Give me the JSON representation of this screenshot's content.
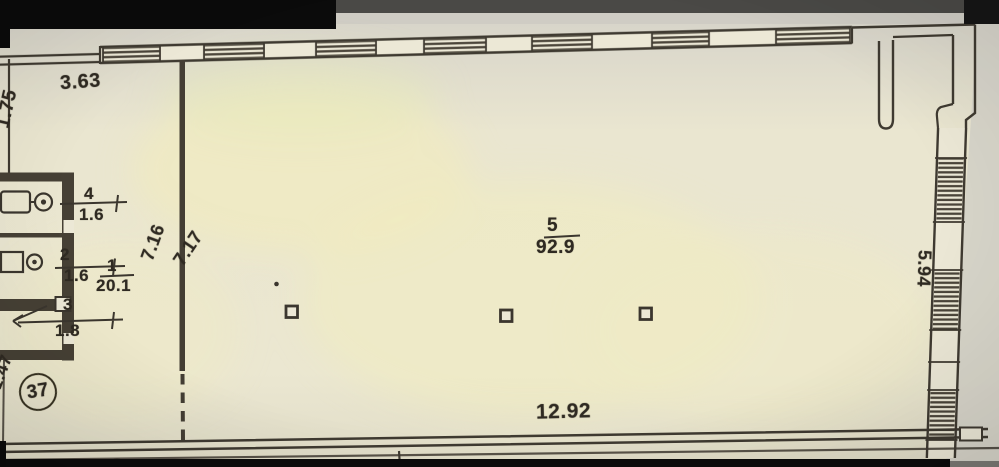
{
  "plan": {
    "unit_number": "37",
    "rooms": [
      {
        "number": "1",
        "area": "20.1"
      },
      {
        "number": "2",
        "area": "1.6"
      },
      {
        "number": "3",
        "area": "1.8"
      },
      {
        "number": "4",
        "area": "1.6"
      },
      {
        "number": "5",
        "area": "92.9"
      }
    ],
    "dimensions": {
      "top_left_width": "3.63",
      "left_upper_height": "1.75",
      "inner_depth_left": "7.16",
      "inner_depth_right": "7.17",
      "hall_bottom_width": "12.92",
      "right_height": "5.94",
      "bottom_left_height": "1.47"
    }
  }
}
